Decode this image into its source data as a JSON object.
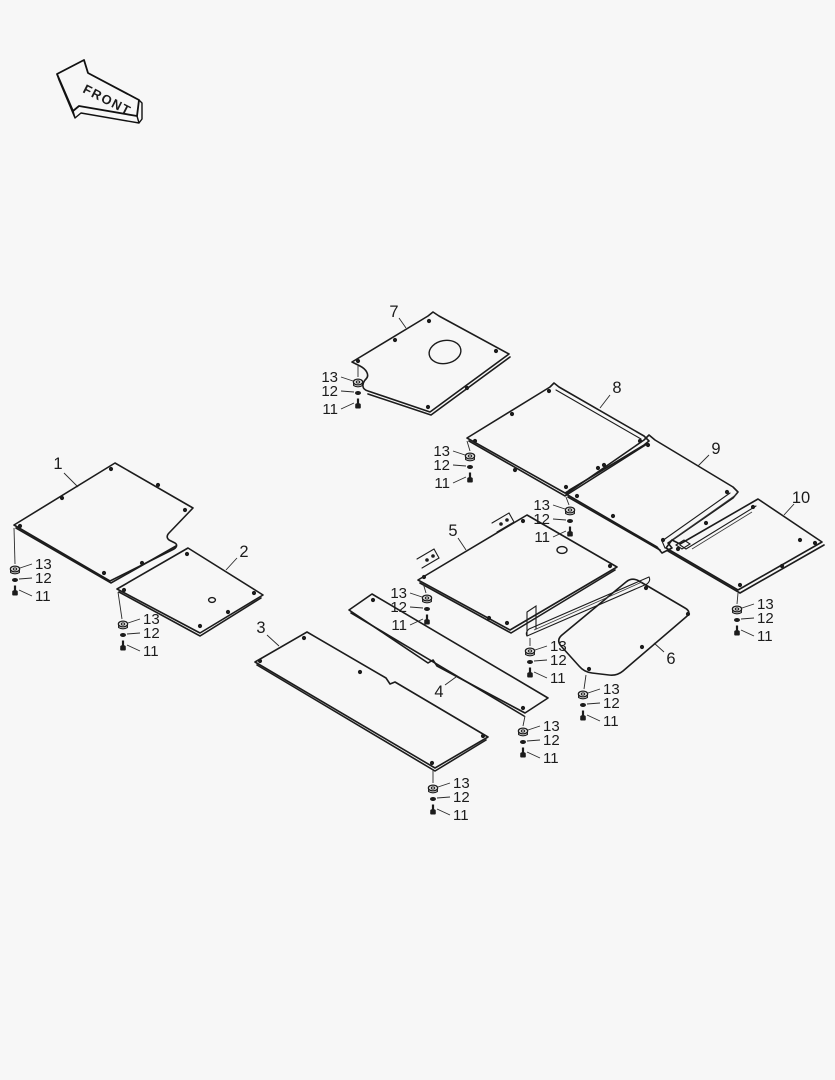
{
  "page": {
    "background": "#f7f7f7",
    "line_color": "#1c1c1c",
    "text_color": "#1c1c1c"
  },
  "front_arrow": {
    "label": "FRONT"
  },
  "parts": [
    {
      "number": "1"
    },
    {
      "number": "2"
    },
    {
      "number": "3"
    },
    {
      "number": "4"
    },
    {
      "number": "5"
    },
    {
      "number": "6"
    },
    {
      "number": "7"
    },
    {
      "number": "8"
    },
    {
      "number": "9"
    },
    {
      "number": "10"
    }
  ],
  "hardware_stacks": [
    {
      "x": 358,
      "y": 382,
      "side": "left",
      "labels": [
        "13",
        "12",
        "11"
      ]
    },
    {
      "x": 470,
      "y": 456,
      "side": "left",
      "labels": [
        "13",
        "12",
        "11"
      ]
    },
    {
      "x": 570,
      "y": 510,
      "side": "left",
      "labels": [
        "13",
        "12",
        "11"
      ]
    },
    {
      "x": 427,
      "y": 598,
      "side": "left",
      "labels": [
        "13",
        "12",
        "11"
      ]
    },
    {
      "x": 15,
      "y": 569,
      "side": "right",
      "labels": [
        "13",
        "12",
        "11"
      ]
    },
    {
      "x": 123,
      "y": 624,
      "side": "right",
      "labels": [
        "13",
        "12",
        "11"
      ]
    },
    {
      "x": 530,
      "y": 651,
      "side": "right",
      "labels": [
        "13",
        "12",
        "11"
      ]
    },
    {
      "x": 583,
      "y": 694,
      "side": "right",
      "labels": [
        "13",
        "12",
        "11"
      ]
    },
    {
      "x": 523,
      "y": 731,
      "side": "right",
      "labels": [
        "13",
        "12",
        "11"
      ]
    },
    {
      "x": 433,
      "y": 788,
      "side": "right",
      "labels": [
        "13",
        "12",
        "11"
      ]
    },
    {
      "x": 737,
      "y": 609,
      "side": "right",
      "labels": [
        "13",
        "12",
        "11"
      ]
    }
  ]
}
